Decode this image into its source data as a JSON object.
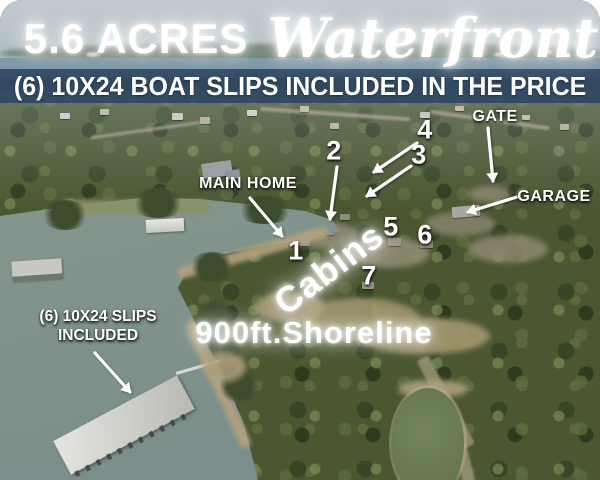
{
  "title": "5.6 Acres Waterfront aerial listing graphic",
  "header": {
    "acres": "5.6 ACRES",
    "waterfront": "Waterfront",
    "banner": "(6) 10X24 BOAT SLIPS INCLUDED IN THE PRICE"
  },
  "annotations": {
    "main_home": "MAIN HOME",
    "gate": "GATE",
    "garage": "GARAGE",
    "cabins": "Cabins",
    "shoreline": "900ft.Shoreline",
    "slips_line1": "(6) 10X24 SLIPS",
    "slips_line2": "INCLUDED",
    "numbers": [
      "1",
      "2",
      "3",
      "4",
      "5",
      "6",
      "7"
    ]
  },
  "scene": {
    "description": "aerial drone photo of wooded lakefront peninsula with boat dock",
    "features": [
      "lake cove",
      "covered boat slip dock",
      "walkway",
      "neighborhood homes",
      "cabins clearing",
      "pond",
      "dirt shoreline"
    ]
  },
  "colors": {
    "banner_bg": "#2f4664",
    "water": "#7e9089",
    "forest": "#4a5731",
    "sky": "#b9c3c9",
    "text": "#ffffff"
  }
}
